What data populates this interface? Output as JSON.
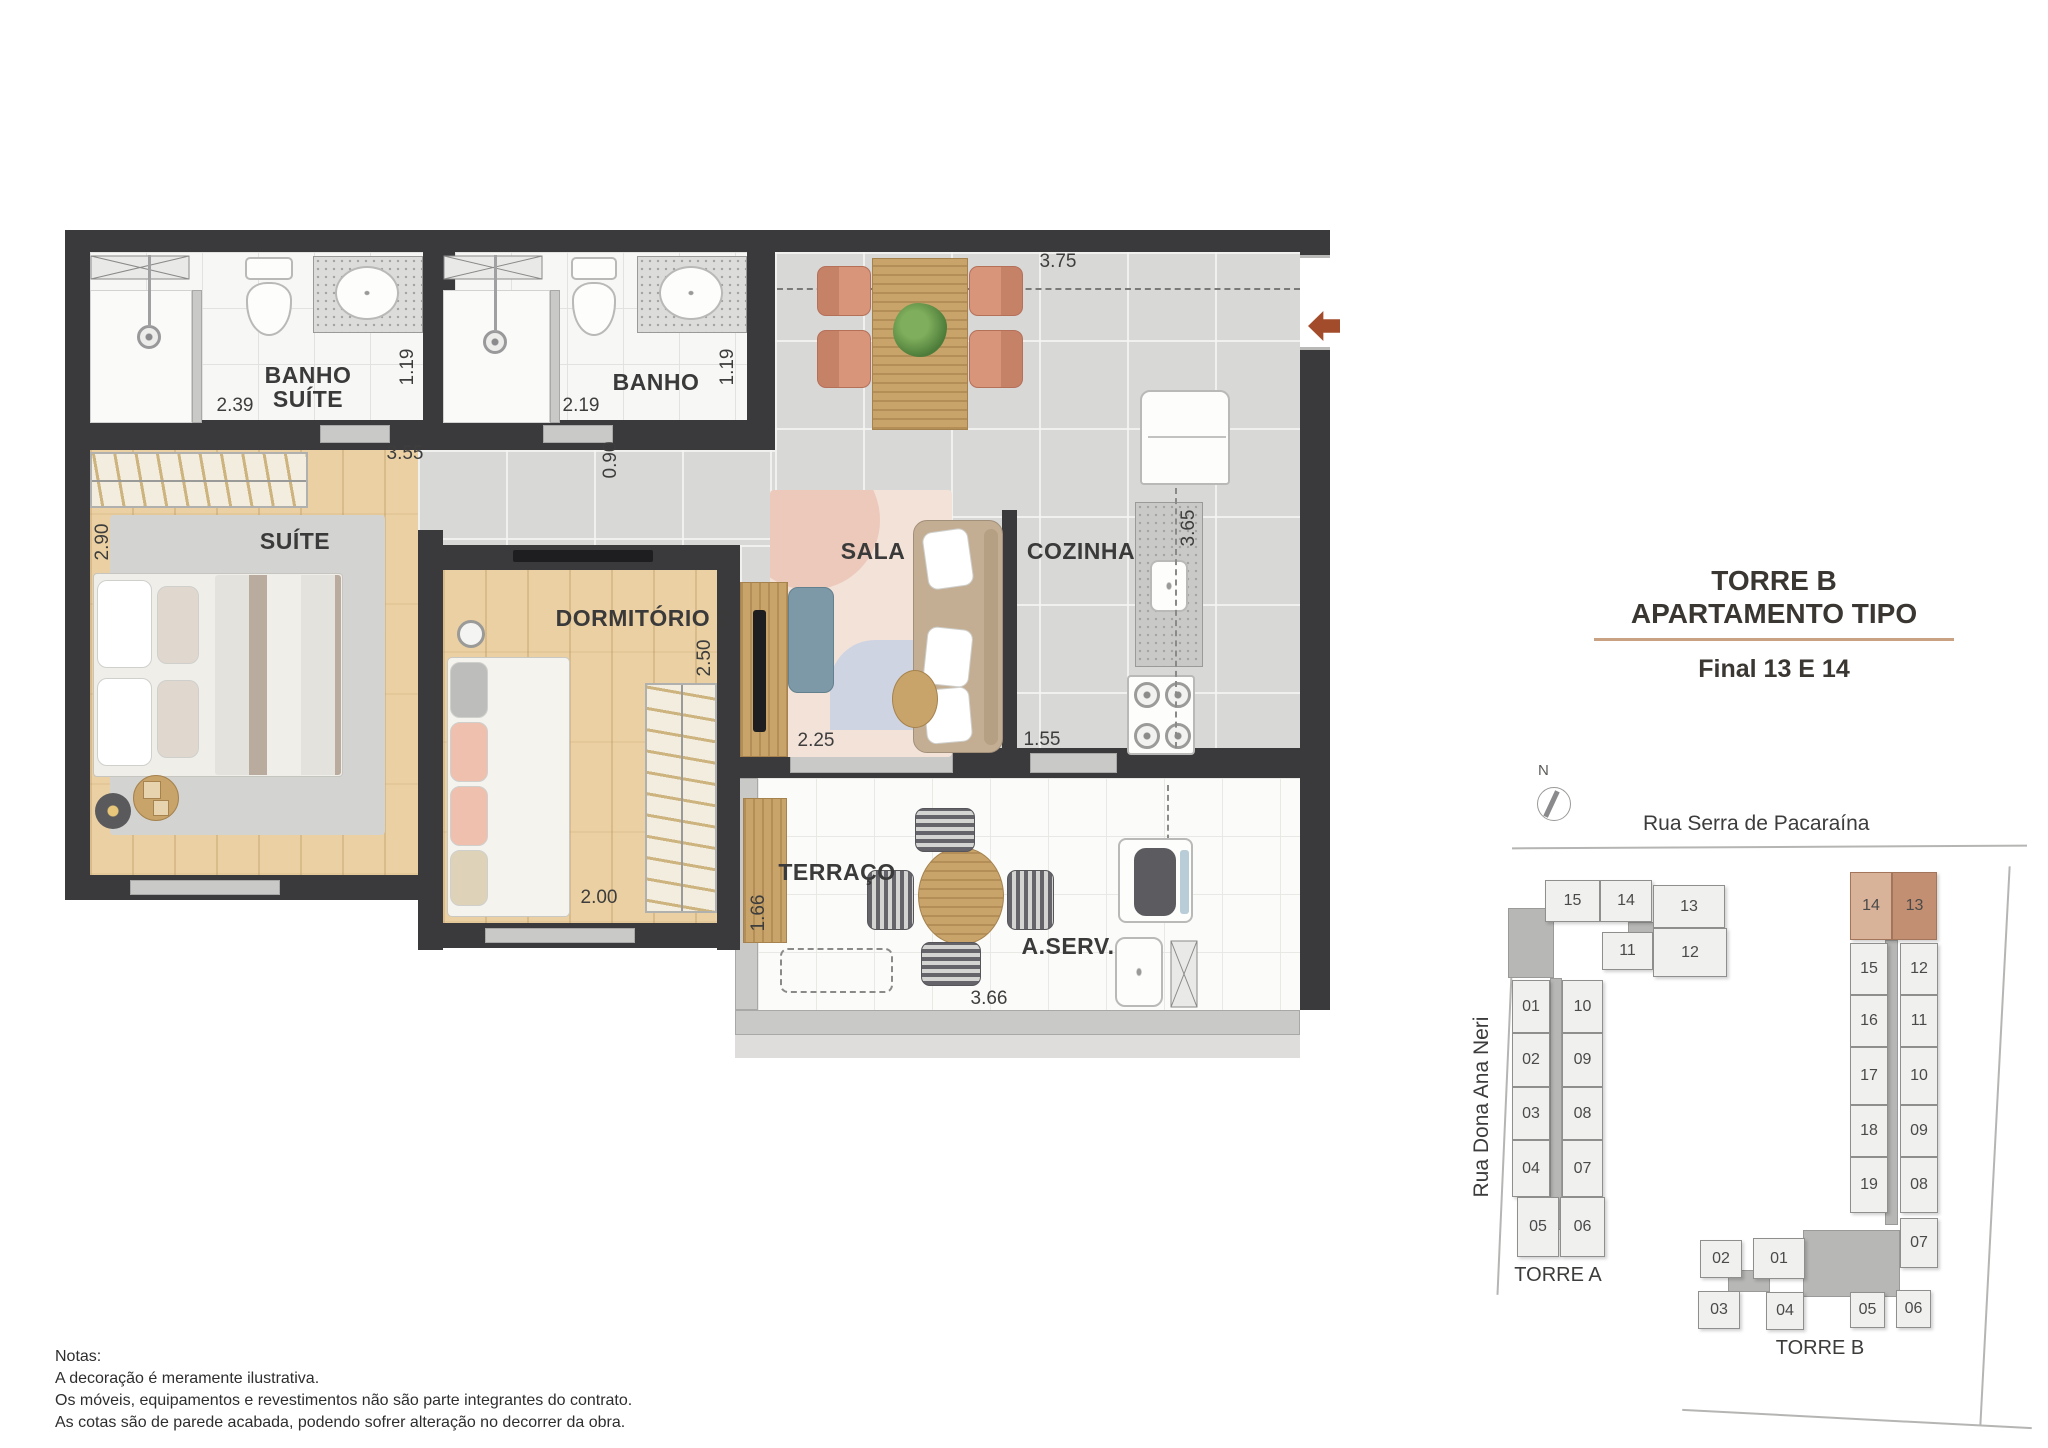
{
  "accents": {
    "entry_arrow": "#a34c2c",
    "title_divider": "#c9a284",
    "unit_14_highlight": "#d9b29a",
    "unit_13_highlight": "#c38f72"
  },
  "title": {
    "line1": "TORRE B",
    "line2": "APARTAMENTO TIPO",
    "subtitle": "Final 13 E 14"
  },
  "plan": {
    "rooms": {
      "banho_suite": {
        "label_line1": "BANHO",
        "label_line2": "SUÍTE",
        "dim_width": "2.39",
        "dim_height": "1.19"
      },
      "banho": {
        "label": "BANHO",
        "dim_width": "2.19",
        "dim_height": "1.19"
      },
      "suite": {
        "label": "SUÍTE",
        "dim_width": "3.55",
        "dim_height": "2.90"
      },
      "dormitorio_2": {
        "label": "DORMITÓRIO 2",
        "dim_width": "2.00",
        "dim_height": "2.50"
      },
      "sala": {
        "label": "SALA",
        "dim_width": "2.25"
      },
      "cozinha": {
        "label": "COZINHA",
        "dim_width": "1.55",
        "dim_height": "3.65"
      },
      "terraco": {
        "label": "TERRAÇO",
        "dim_width": "3.66",
        "dim_height": "1.66"
      },
      "area_servico": {
        "label": "A.SERV."
      }
    },
    "dims": {
      "dining_width": "3.75",
      "hall_width": "0.90"
    }
  },
  "site": {
    "north_label": "N",
    "street_top": "Rua Serra de Pacaraína",
    "street_left": "Rua Dona Ana Neri",
    "torre_a": {
      "label": "TORRE A",
      "units": [
        "15",
        "14",
        "13",
        "11",
        "12",
        "01",
        "10",
        "02",
        "09",
        "03",
        "08",
        "04",
        "07",
        "05",
        "06"
      ]
    },
    "torre_b": {
      "label": "TORRE B",
      "units": [
        "14",
        "13",
        "15",
        "12",
        "16",
        "11",
        "17",
        "10",
        "18",
        "09",
        "19",
        "08",
        "07",
        "02",
        "01",
        "03",
        "04",
        "05",
        "06"
      ]
    }
  },
  "notes": {
    "heading": "Notas:",
    "line1": "A decoração é meramente ilustrativa.",
    "line2": "Os móveis, equipamentos e revestimentos não são parte integrantes do contrato.",
    "line3": "As cotas são de parede acabada, podendo sofrer alteração no decorrer da obra."
  }
}
